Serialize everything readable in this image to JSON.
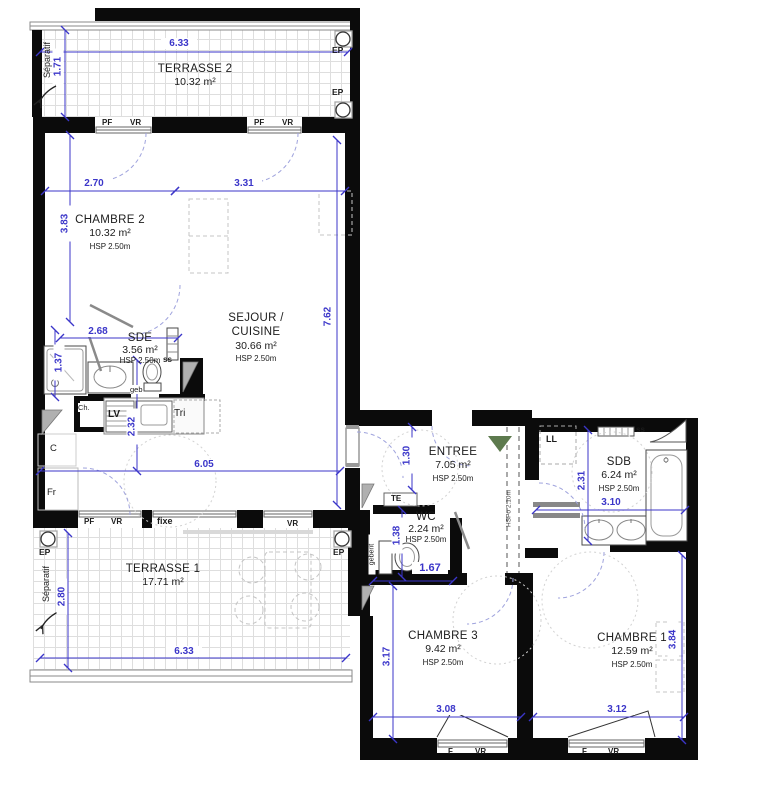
{
  "rooms": {
    "terrasse2": {
      "name": "TERRASSE 2",
      "area": "10.32 m²"
    },
    "chambre2": {
      "name": "CHAMBRE 2",
      "area": "10.32 m²",
      "hsp": "HSP 2.50m"
    },
    "sejour": {
      "name1": "SEJOUR /",
      "name2": "CUISINE",
      "area": "30.66 m²",
      "hsp": "HSP 2.50m"
    },
    "sde": {
      "name": "SDE",
      "area": "3.56 m²",
      "hsp": "HSP 2.50m"
    },
    "entree": {
      "name": "ENTREE",
      "area": "7.05 m²",
      "hsp": "HSP 2.50m"
    },
    "wc": {
      "name": "WC",
      "area": "2.24 m²",
      "hsp": "HSP 2.50m"
    },
    "sdb": {
      "name": "SDB",
      "area": "6.24 m²",
      "hsp": "HSP 2.50m"
    },
    "terrasse1": {
      "name": "TERRASSE 1",
      "area": "17.71 m²"
    },
    "chambre3": {
      "name": "CHAMBRE 3",
      "area": "9.42 m²",
      "hsp": "HSP 2.50m"
    },
    "chambre1": {
      "name": "CHAMBRE 1",
      "area": "12.59 m²",
      "hsp": "HSP 2.50m"
    }
  },
  "dims": {
    "terrasse2_width": "6.33",
    "terrasse2_depth": "1.71",
    "chambre2_width": "2.70",
    "sejour_width": "3.31",
    "chambre2_depth": "3.83",
    "sejour_depth": "7.62",
    "sde_width": "2.68",
    "shower_depth": "1.37",
    "kitchen_depth": "2.32",
    "sejour_bottom_width": "6.05",
    "entree_depth": "1.30",
    "wc_depth": "1.38",
    "wc_width": "1.67",
    "sdb_depth": "2.31",
    "sdb_width": "3.10",
    "terrasse1_depth": "2.80",
    "terrasse1_width": "6.33",
    "chambre3_depth": "3.17",
    "chambre3_width": "3.08",
    "chambre1_width": "3.12",
    "chambre1_depth": "3.84"
  },
  "labels": {
    "separatif": "Séparatif",
    "ep": "EP",
    "pf": "PF",
    "vr": "VR",
    "f": "F",
    "fixe": "fixe",
    "te": "TE",
    "ll": "LL",
    "ss": "ss",
    "geb": "geb",
    "geberit": "geberit",
    "ch": "Ch.",
    "lv": "LV",
    "tri": "Tri",
    "c": "C",
    "fr": "Fr",
    "hspo": "HSPo 2.10m"
  },
  "colors": {
    "wall": "#0b0b0b",
    "dimension": "#3b36c9",
    "entry_arrow": "#5d7a4e"
  }
}
